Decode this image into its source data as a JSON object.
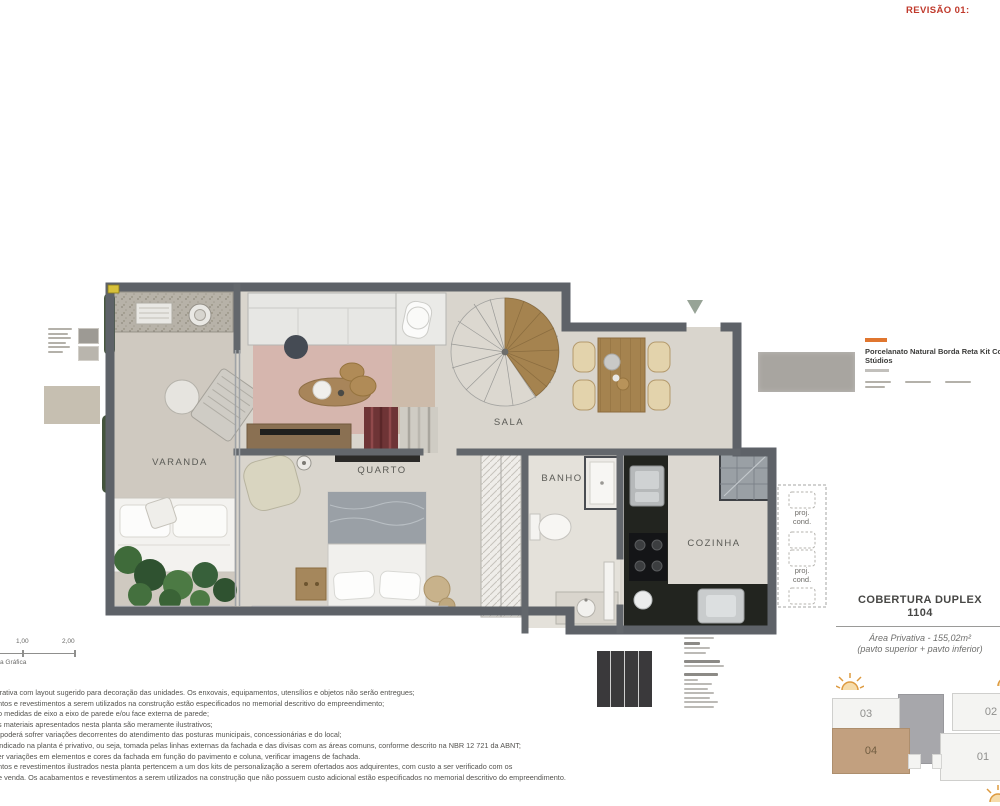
{
  "revision": "REVISÃO 01:",
  "plan": {
    "rooms": [
      {
        "id": "varanda",
        "label": "VARANDA"
      },
      {
        "id": "quarto",
        "label": "QUARTO"
      },
      {
        "id": "sala",
        "label": "SALA"
      },
      {
        "id": "banho",
        "label": "BANHO"
      },
      {
        "id": "cozinha",
        "label": "COZINHA"
      }
    ],
    "proj_cond": {
      "line1": "proj.",
      "line2": "cond."
    }
  },
  "material": {
    "title_line1": "Porcelanato Natural Borda Reta Kit Co",
    "title_line2": "Stúdios"
  },
  "unit_info": {
    "title_line1": "COBERTURA DUPLEX",
    "title_line2": "1104",
    "area": "Área Privativa - 155,02m²",
    "pavements": "(pavto superior + pavto inferior)"
  },
  "scale_bar": {
    "tick1": "1,00",
    "tick2": "2,00",
    "caption": "a Gráfica"
  },
  "keyplan": {
    "units": [
      {
        "label": "03",
        "highlighted": false
      },
      {
        "label": "02",
        "highlighted": false
      },
      {
        "label": "04",
        "highlighted": true
      },
      {
        "label": "01",
        "highlighted": false
      }
    ],
    "highlight_color": "#c2a07f"
  },
  "disclaimer": {
    "lines": [
      "strativa com layout sugerido para decoração das unidades. Os enxovais, equipamentos, utensílios e objetos não serão entregues;",
      "entos e revestimentos a serem utilizados na construção estão especificados no memorial descritivo do empreendimento;",
      "ão medidas de eixo a eixo de parede e/ou face externa de parede;",
      "os materiais apresentados nesta planta são meramente ilustrativos;",
      "a poderá sofrer variações decorrentes do atendimento das posturas municipais, concessionárias e do local;",
      "l indicado na planta é privativo, ou seja, tomada pelas linhas externas da fachada e das divisas com as áreas comuns, conforme descrito na NBR 12 721 da ABNT;",
      "ver variações em elementos e cores da fachada em função do pavimento e coluna, verificar imagens de fachada.",
      "entos e revestimentos ilustrados nesta planta pertencem a um dos kits de personalização a serem ofertados aos adquirentes, com custo a ser verificado com os",
      "de venda. Os acabamentos e revestimentos a serem utilizados na construção que não possuem custo adicional estão especificados no memorial descritivo do empreendimento."
    ]
  },
  "colors": {
    "revision_red": "#c0392b",
    "wall_gray": "#5e6268",
    "floor": "#d9d5cd",
    "wood": "#a5834f",
    "rug_pink": "#d6b6ae",
    "keyplan_highlight": "#c2a07f",
    "sun_orange": "#dd9a3f"
  }
}
